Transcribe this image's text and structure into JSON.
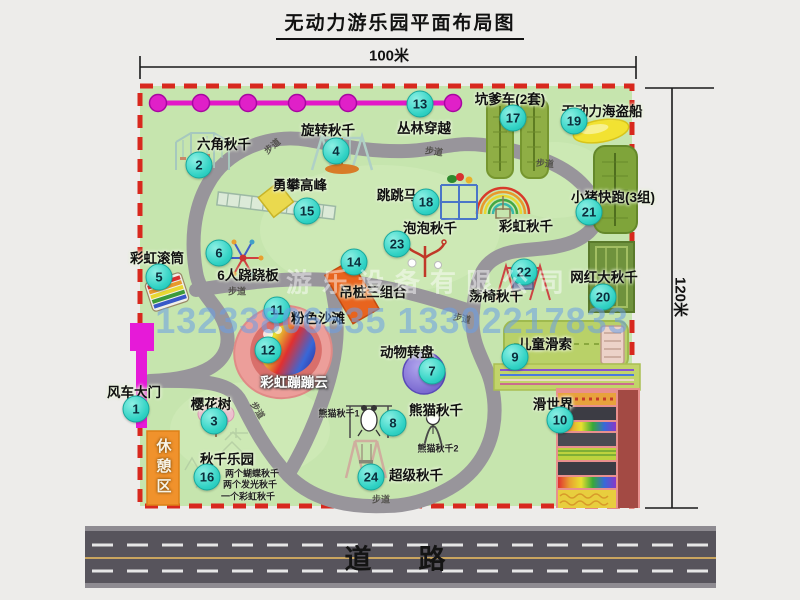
{
  "title": "无动力游乐园平面布局图",
  "dimensions": {
    "width_label": "100米",
    "height_label": "120米"
  },
  "road_label": "道　路",
  "watermark": {
    "company": "游乐设备有限公司",
    "phone": "13233806535 13302217833"
  },
  "rest_area_label": "休憩区",
  "path_label": "步道",
  "attractions": [
    {
      "num": "1",
      "label": "风车大门"
    },
    {
      "num": "2",
      "label": "六角秋千"
    },
    {
      "num": "3",
      "label": "樱花树"
    },
    {
      "num": "4",
      "label": "旋转秋千"
    },
    {
      "num": "5",
      "label": "彩虹滚筒"
    },
    {
      "num": "6",
      "label": "6人跷跷板"
    },
    {
      "num": "7",
      "label": "动物转盘"
    },
    {
      "num": "8",
      "label": "熊猫秋千",
      "subs": [
        "熊猫秋千1",
        "熊猫秋千2"
      ]
    },
    {
      "num": "9",
      "label": "儿童滑索"
    },
    {
      "num": "10",
      "label": "滑世界"
    },
    {
      "num": "11",
      "label": "粉色沙滩"
    },
    {
      "num": "12",
      "label": "彩虹蹦蹦云"
    },
    {
      "num": "13",
      "label": "丛林穿越"
    },
    {
      "num": "14",
      "label": "吊桩三组合"
    },
    {
      "num": "15",
      "label": "勇攀高峰"
    },
    {
      "num": "16",
      "label": "秋千乐园",
      "subs": [
        "两个蝴蝶秋千",
        "两个发光秋千",
        "一个彩虹秋千"
      ]
    },
    {
      "num": "17",
      "label": "坑爹车(2套)"
    },
    {
      "num": "18",
      "label": "跳跳马"
    },
    {
      "num": "19",
      "label": "无动力海盗船"
    },
    {
      "num": "20",
      "label": "网红大秋千"
    },
    {
      "num": "21",
      "label": "小猪快跑(3组)"
    },
    {
      "num": "22",
      "label": "荡椅秋千"
    },
    {
      "num": "23",
      "label": "泡泡秋千"
    },
    {
      "num": "24",
      "label": "超级秋千"
    },
    {
      "num": "",
      "label": "彩虹秋千"
    }
  ],
  "colors": {
    "park_green": "#c6e5ae",
    "border_dash": "#d8281e",
    "path_gray": "#98959b",
    "chain_magenta": "#e318c8",
    "gate_magenta": "#e61ad8",
    "rest_orange": "#f0922c",
    "badge_teal": "#30d2c4",
    "road_gray": "#57545c"
  }
}
